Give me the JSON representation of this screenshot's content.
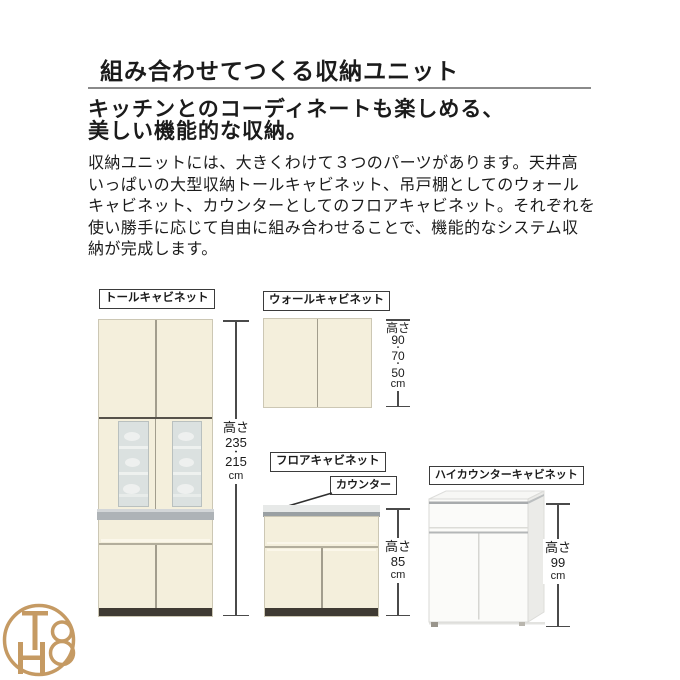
{
  "header": {
    "title": "組み合わせてつくる収納ユニット",
    "subtitle_lines": [
      "キッチンとのコーディネートも楽しめる、",
      "美しい機能的な収納。"
    ],
    "body_lines": [
      "収納ユニットには、大きくわけて３つのパーツがあります。天井高",
      "いっぱいの大型収納トールキャビネット、吊戸棚としてのウォール",
      "キャビネット、カウンターとしてのフロアキャビネット。それぞれを",
      "使い勝手に応じて自由に組み合わせることで、機能的なシステム収",
      "納が完成します。"
    ]
  },
  "cabinets": {
    "tall": {
      "label": "トールキャビネット",
      "dimension": {
        "lines": [
          "高さ",
          "235",
          "・",
          "215",
          "cm"
        ]
      }
    },
    "wall": {
      "label": "ウォールキャビネット",
      "dimension": {
        "lines": [
          "高さ",
          "90",
          "・",
          "70",
          "・",
          "50",
          "cm"
        ]
      }
    },
    "floor": {
      "label": "フロアキャビネット",
      "counter_label": "カウンター",
      "dimension": {
        "lines": [
          "高さ",
          "85",
          "cm"
        ]
      }
    },
    "high_counter": {
      "label": "ハイカウンターキャビネット",
      "dimension": {
        "lines": [
          "高さ",
          "99",
          "cm"
        ]
      }
    }
  },
  "logo": {
    "monogram": "TH8"
  },
  "colors": {
    "cabinet_cream": "#f4efdc",
    "counter_gray": "#aeb3b7",
    "base_dark": "#3f3a33",
    "glass_gray": "#dbe1e0",
    "logo_gold": "#c59a63"
  }
}
